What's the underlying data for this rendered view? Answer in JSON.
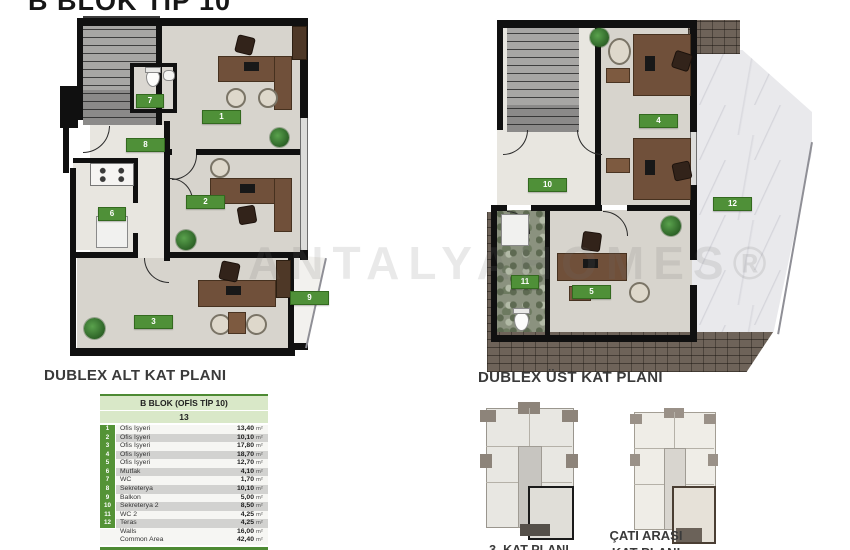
{
  "title": "B BLOK TIP 10",
  "watermark": "ANTALYAHOMES®",
  "plans": {
    "lower": {
      "caption": "DUBLEX ALT KAT PLANI",
      "rooms": {
        "r1": "1",
        "r2": "2",
        "r3": "3",
        "r6": "6",
        "r7": "7",
        "r8": "8",
        "r9": "9"
      }
    },
    "upper": {
      "caption": "DUBLEX ÜST KAT PLANI",
      "rooms": {
        "r4": "4",
        "r5": "5",
        "r10": "10",
        "r11": "11",
        "r12": "12"
      }
    }
  },
  "mini_plans": {
    "left_caption": "3. KAT PLANI",
    "right_caption_line1": "ÇATI ARASI",
    "right_caption_line2": "KAT PLANI"
  },
  "area_table": {
    "title": "B BLOK (OFİS TİP 10)",
    "unit_no": "13",
    "rows": [
      {
        "no": "1",
        "name": "Ofis İşyeri",
        "area": "13,40",
        "unit": "m²"
      },
      {
        "no": "2",
        "name": "Ofis İşyeri",
        "area": "10,10",
        "unit": "m²"
      },
      {
        "no": "3",
        "name": "Ofis İşyeri",
        "area": "17,80",
        "unit": "m²"
      },
      {
        "no": "4",
        "name": "Ofis İşyeri",
        "area": "18,70",
        "unit": "m²"
      },
      {
        "no": "5",
        "name": "Ofis İşyeri",
        "area": "12,70",
        "unit": "m²"
      },
      {
        "no": "6",
        "name": "Mutfak",
        "area": "4,10",
        "unit": "m²"
      },
      {
        "no": "7",
        "name": "WC",
        "area": "1,70",
        "unit": "m²"
      },
      {
        "no": "8",
        "name": "Sekreterya",
        "area": "10,10",
        "unit": "m²"
      },
      {
        "no": "9",
        "name": "Balkon",
        "area": "5,00",
        "unit": "m²"
      },
      {
        "no": "10",
        "name": "Sekreterya 2",
        "area": "8,50",
        "unit": "m²"
      },
      {
        "no": "11",
        "name": "WC 2",
        "area": "4,25",
        "unit": "m²"
      },
      {
        "no": "12",
        "name": "Teras",
        "area": "4,25",
        "unit": "m²"
      },
      {
        "no": "",
        "name": "Walls",
        "area": "16,00",
        "unit": "m²"
      },
      {
        "no": "",
        "name": "Common Area",
        "area": "42,40",
        "unit": "m²"
      }
    ],
    "total": {
      "name": "Total Area",
      "area": "169,00",
      "unit": "m²"
    }
  },
  "colors": {
    "accent_green": "#4f9038",
    "table_header_bg": "#d9e8c8",
    "table_total_bg": "#4d8a33",
    "wall_black": "#101010",
    "office_floor": "#d7d4cd"
  }
}
